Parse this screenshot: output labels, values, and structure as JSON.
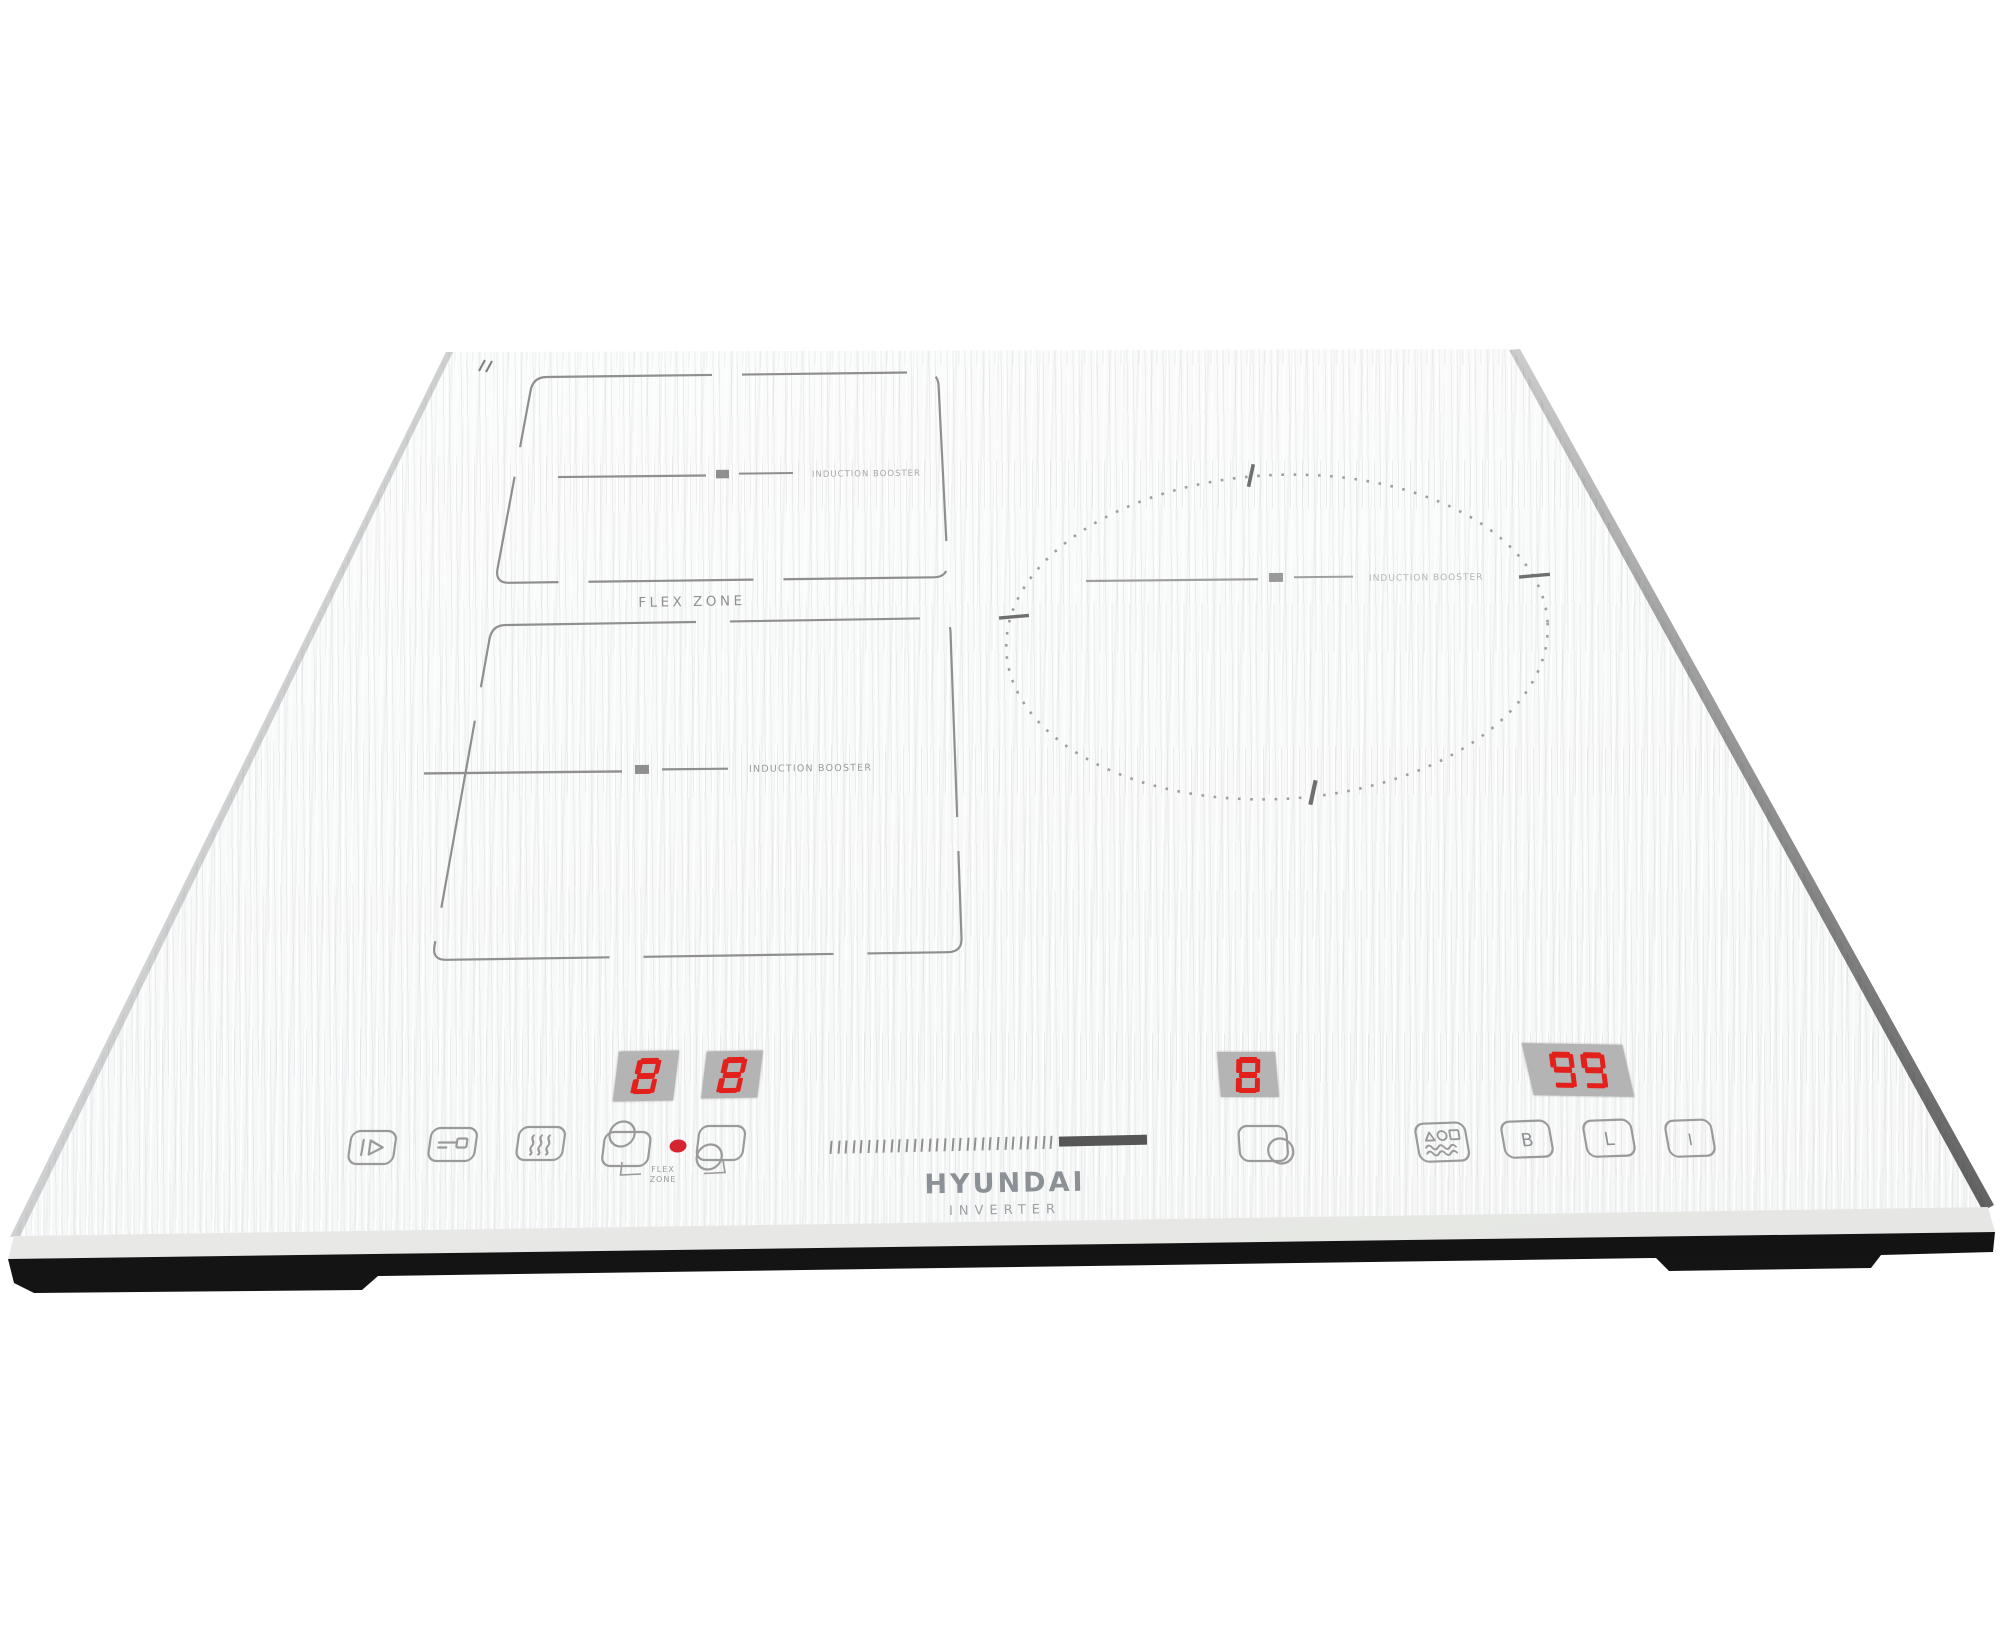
{
  "product": {
    "brand": "HYUNDAI",
    "brand_sub": "INVERTER"
  },
  "zones": {
    "flex": {
      "label": "FLEX ZONE",
      "upper_booster_label": "INDUCTION BOOSTER",
      "lower_booster_label": "INDUCTION BOOSTER"
    },
    "round": {
      "booster_label": "INDUCTION BOOSTER"
    }
  },
  "displays": [
    {
      "name": "flex-upper-power-display",
      "value": "8"
    },
    {
      "name": "flex-lower-power-display",
      "value": "8"
    },
    {
      "name": "round-zone-power-display",
      "value": "8"
    },
    {
      "name": "timer-display",
      "value": "99"
    }
  ],
  "slider": {
    "tick_count": 30
  },
  "controls": {
    "flex_bracket_line1": "FLEX",
    "flex_bracket_line2": "ZONE",
    "booster_letter": "B",
    "lock_letter": "L",
    "power_letter": "I",
    "icons": [
      "pause-start-icon",
      "key-lock-icon",
      "keep-warm-icon",
      "flex-upper-zone-icon",
      "power-indicator-dot",
      "flex-lower-zone-icon",
      "round-zone-select-icon",
      "cook-functions-icon",
      "booster-icon",
      "lock-icon",
      "power-icon"
    ]
  },
  "colors": {
    "led_red": "#e2211c",
    "display_bg": "#b4b4b4",
    "marking_gray": "#8f8f8f",
    "indicator_red": "#d52330",
    "base_black": "#141414",
    "glass_white": "#f8f9f9"
  }
}
